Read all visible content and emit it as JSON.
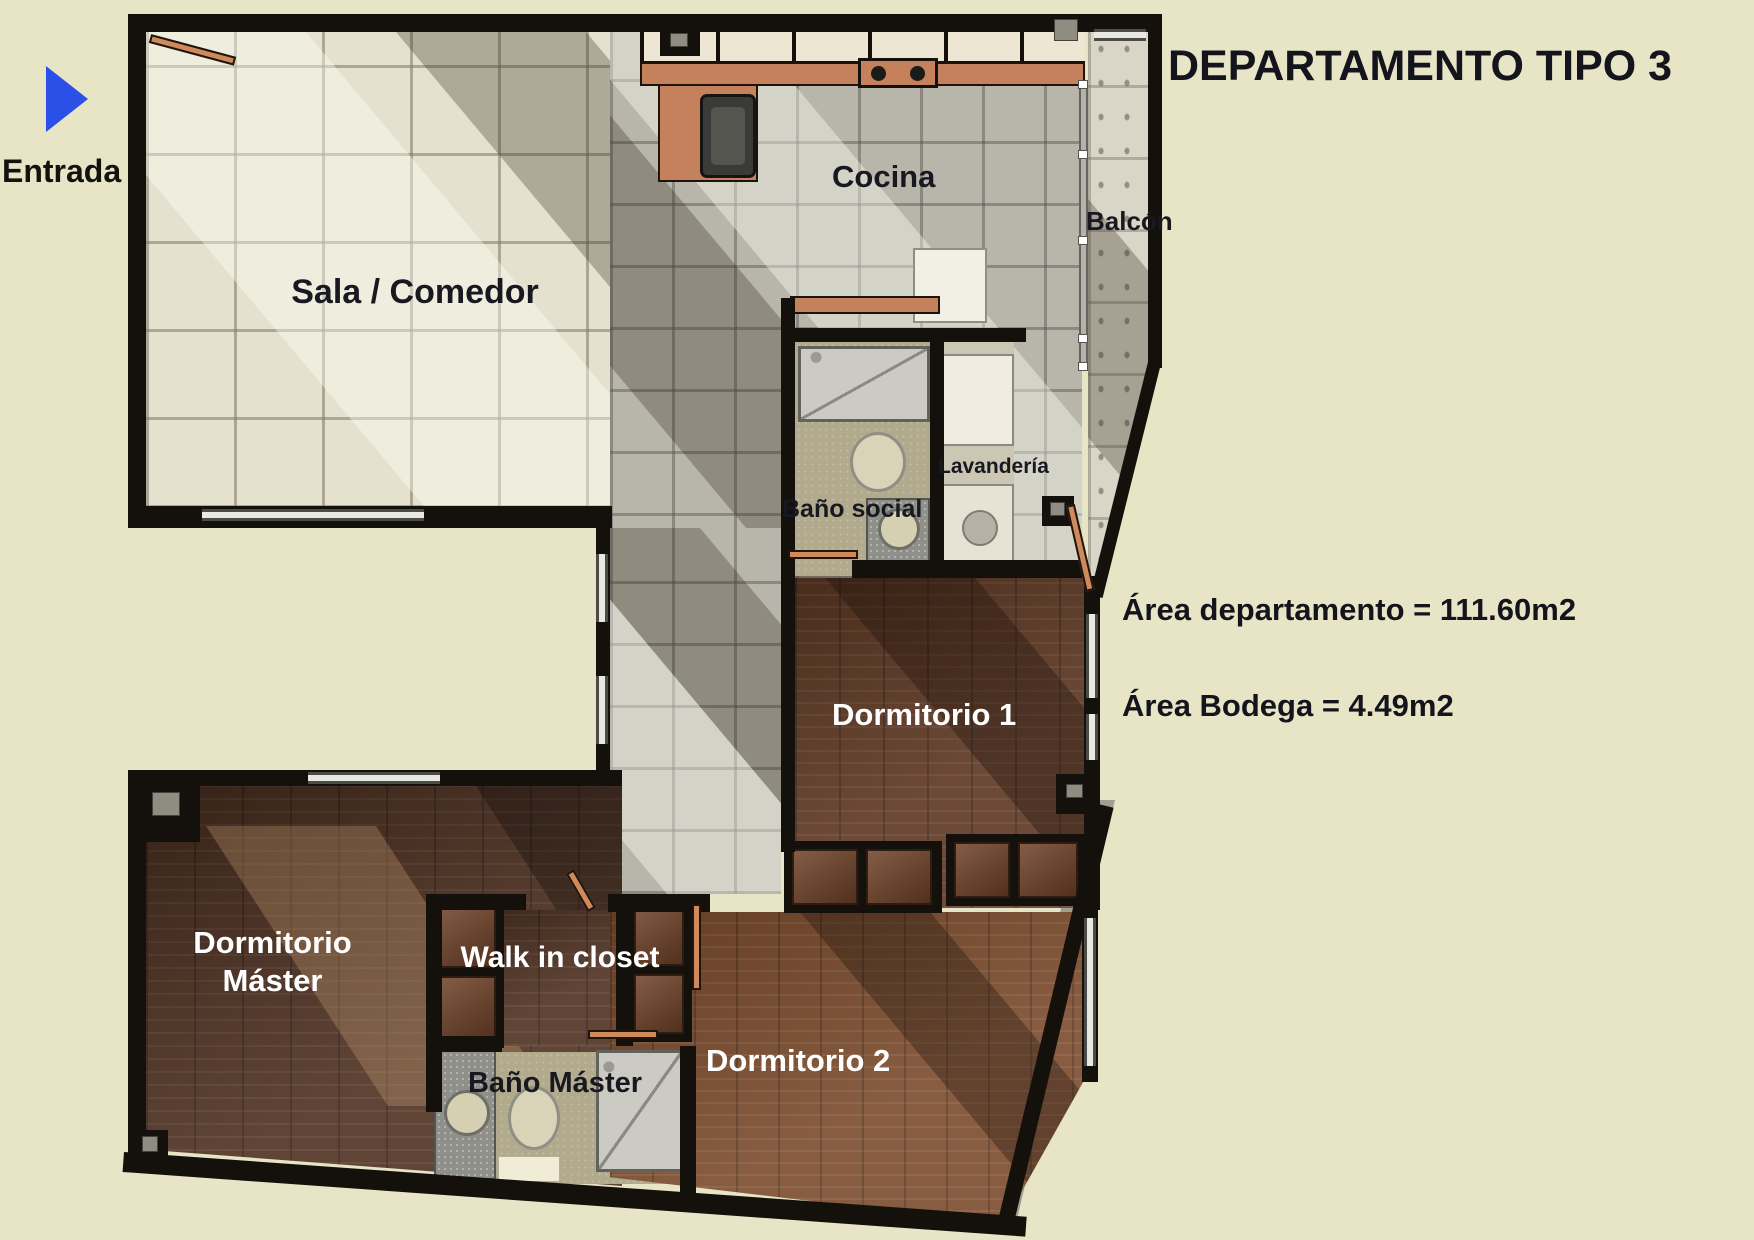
{
  "title": "DEPARTAMENTO TIPO 3",
  "entrance": {
    "label": "Entrada"
  },
  "rooms": {
    "sala": {
      "label": "Sala / Comedor"
    },
    "cocina": {
      "label": "Cocina"
    },
    "balcon": {
      "label": "Balcón"
    },
    "bano_social": {
      "label": "Baño social"
    },
    "lavanderia": {
      "label": "Lavandería"
    },
    "dormitorio_1": {
      "label": "Dormitorio 1"
    },
    "dormitorio_master": {
      "label": "Dormitorio Máster"
    },
    "walk_in_closet": {
      "label": "Walk in closet"
    },
    "bano_master": {
      "label": "Baño Máster"
    },
    "dormitorio_2": {
      "label": "Dormitorio 2"
    }
  },
  "annotations": {
    "area_departamento": "Área departamento = 111.60m2",
    "area_bodega": "Área Bodega = 4.49m2"
  },
  "colors": {
    "background": "#e8e5c7",
    "walls": "#14100b",
    "title_text": "#14141d",
    "tile_beige": "#e4e1ce",
    "tile_gray": "#b8b6ab",
    "tile_balcony": "#d9d6c7",
    "wood_dark": "#4e3020",
    "wood_medium": "#7a4a2b",
    "counter_copper": "#c5805c",
    "bath_floor": "#b2aa8c",
    "door_copper": "#cf8a5c",
    "arrow_blue": "#2b50e8"
  }
}
